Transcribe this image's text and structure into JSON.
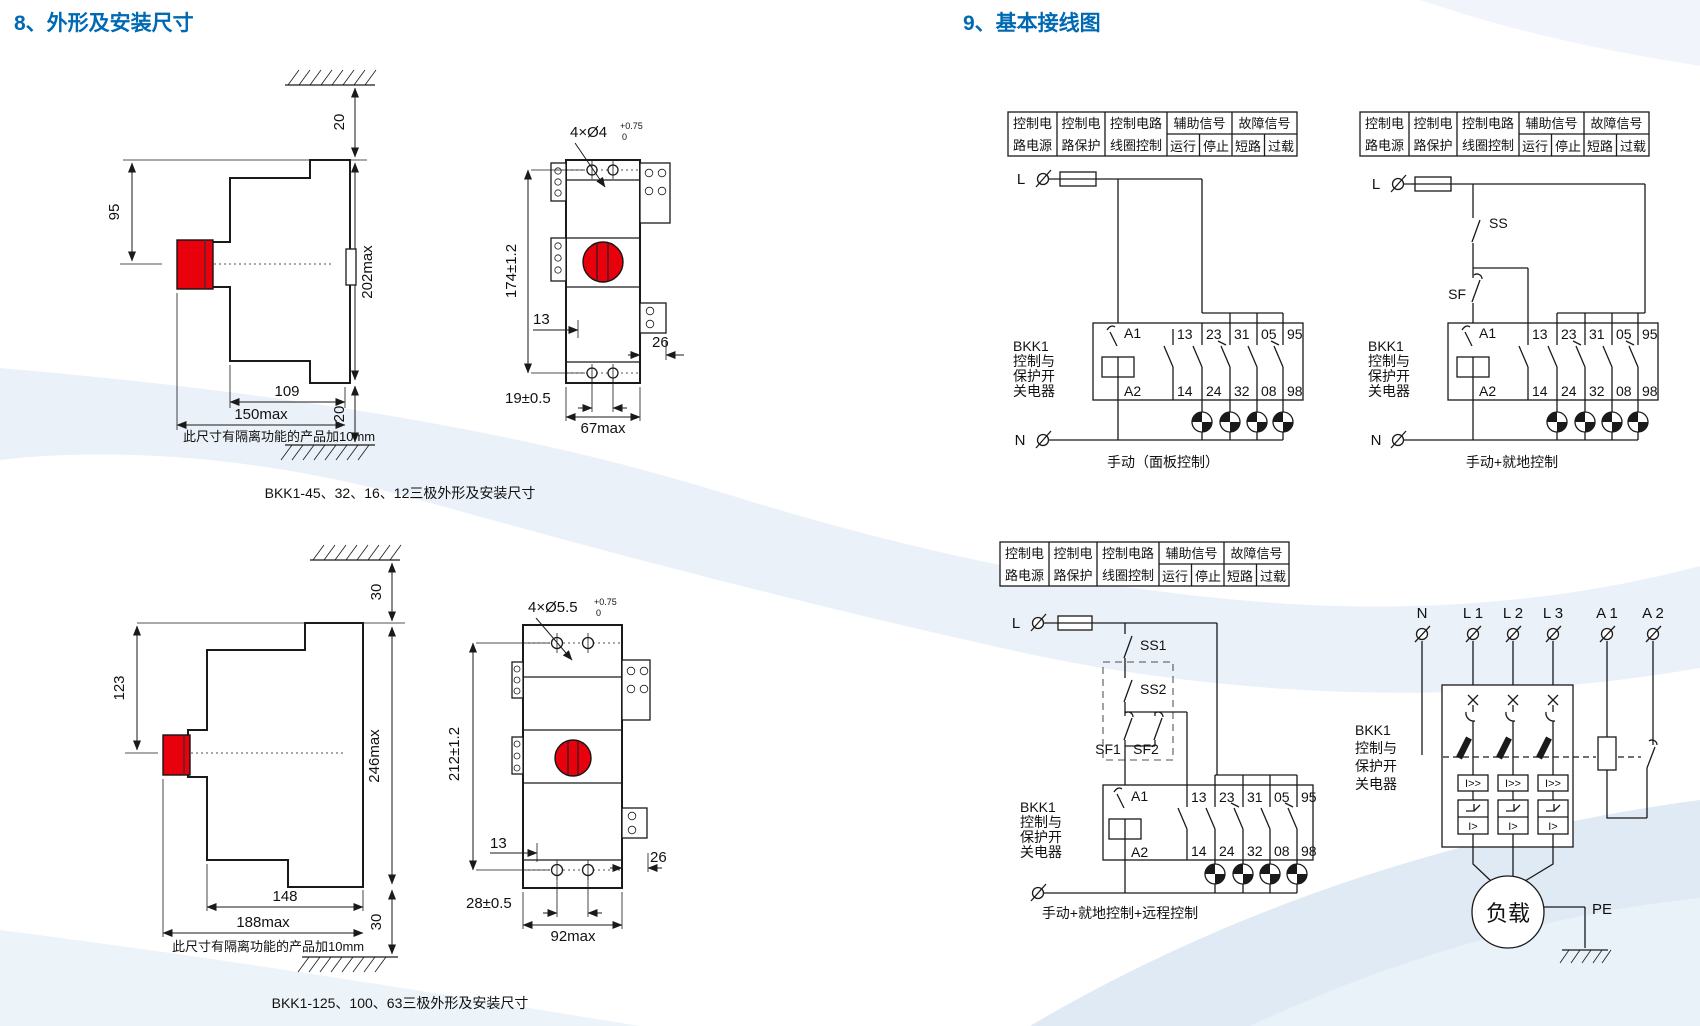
{
  "titles": {
    "section8": "8、外形及安装尺寸",
    "section9": "9、基本接线图"
  },
  "colors": {
    "title_blue": "#0069b4",
    "button_red": "#e8000d",
    "line": "#1a1a1a",
    "wave": "#dce8f3"
  },
  "outline_top": {
    "side": {
      "gap_top": "20",
      "button_height": "95",
      "height_max": "202max",
      "depth": "109",
      "depth_max": "150max",
      "gap_bottom": "20",
      "note": "此尺寸有隔离功能的产品加10mm"
    },
    "front": {
      "holes": "4×Ø4",
      "tol_up": "+0.75",
      "tol_dn": "0",
      "height": "174±1.2",
      "offset": "13",
      "tab": "26",
      "pitch": "19±0.5",
      "width": "67max"
    },
    "caption": "BKK1-45、32、16、12三极外形及安装尺寸"
  },
  "outline_bottom": {
    "side": {
      "gap_top": "30",
      "button_height": "123",
      "height_max": "246max",
      "depth": "148",
      "depth_max": "188max",
      "gap_bottom": "30",
      "note": "此尺寸有隔离功能的产品加10mm"
    },
    "front": {
      "holes": "4×Ø5.5",
      "tol_up": "+0.75",
      "tol_dn": "0",
      "height": "212±1.2",
      "offset": "13",
      "tab": "26",
      "pitch": "28±0.5",
      "width": "92max"
    },
    "caption": "BKK1-125、100、63三极外形及安装尺寸"
  },
  "wiring": {
    "header": {
      "c1l1": "控制电",
      "c1l2": "路电源",
      "c2l1": "控制电",
      "c2l2": "路保护",
      "c3l1": "控制电路",
      "c3l2": "线圈控制",
      "aux": "辅助信号",
      "run": "运行",
      "stop": "停止",
      "fault": "故障信号",
      "short_circuit": "短路",
      "overload": "过载"
    },
    "device_lines": [
      "BKK1",
      "控制与",
      "保护开",
      "关电器"
    ],
    "phase": "L",
    "neutral": "N",
    "a1": "A1",
    "a2": "A2",
    "contacts_top": [
      "13",
      "23",
      "31",
      "05",
      "95"
    ],
    "contacts_bot": [
      "14",
      "24",
      "32",
      "08",
      "98"
    ],
    "d1": {
      "caption": "手动（面板控制）"
    },
    "d2": {
      "caption": "手动+就地控制",
      "ss": "SS",
      "sf": "SF"
    },
    "d3": {
      "caption": "手动+就地控制+远程控制",
      "ss1": "SS1",
      "ss2": "SS2",
      "sf1": "SF1",
      "sf2": "SF2"
    },
    "power": {
      "t0": "N",
      "t1": "L 1",
      "t2": "L 2",
      "t3": "L 3",
      "t4": "A 1",
      "t5": "A 2",
      "inst": "I>>",
      "ovl": "I>",
      "load": "负载",
      "pe": "PE"
    }
  }
}
